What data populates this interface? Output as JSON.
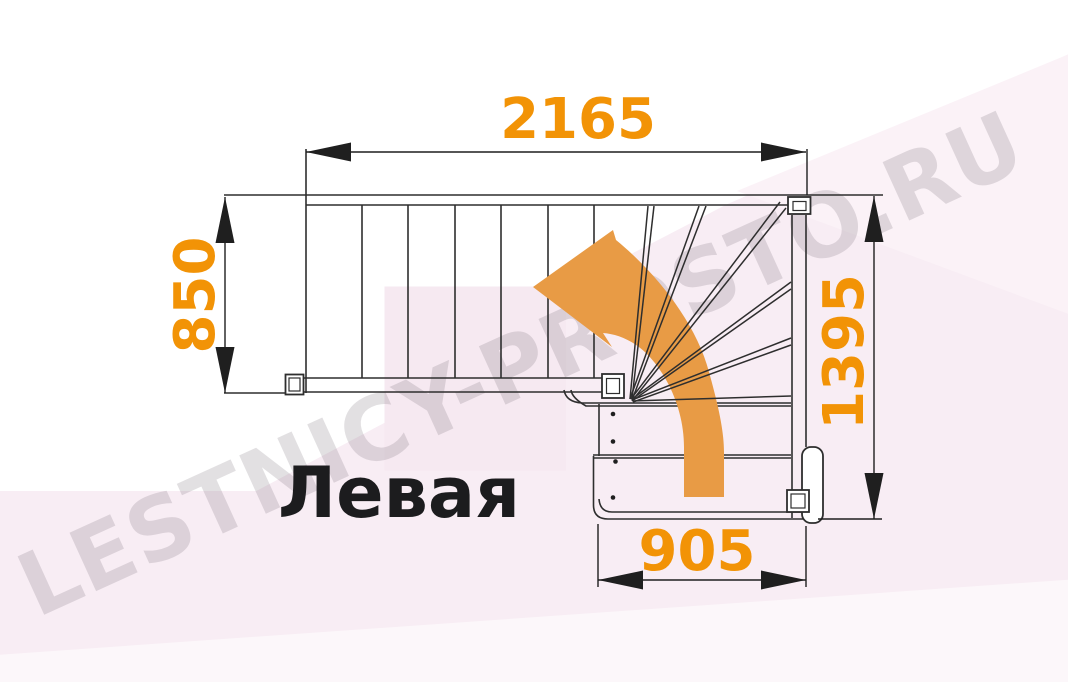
{
  "diagram": {
    "type": "staircase-floor-plan",
    "orientation_label": "Левая",
    "watermark": "LESTNICY-PROSTO.RU",
    "dimensions": {
      "top": "2165",
      "left": "850",
      "right": "1395",
      "bottom": "905"
    },
    "features": {
      "straight_treads": 6,
      "winder_fan_treads": 6,
      "turn": "quarter-turn left with winders"
    },
    "colors": {
      "dimension_text": "#F29306",
      "direction_arrow": "#E89B45",
      "drawing_line": "#2E2E2E",
      "watermark_gray": "#D9D4D7",
      "background_pink": "#F8EDF4"
    }
  }
}
